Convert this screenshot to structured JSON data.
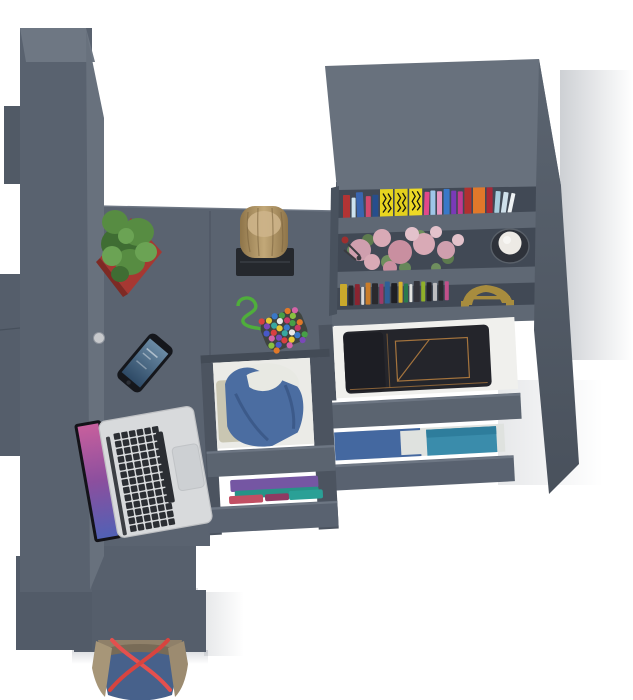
{
  "meta": {
    "scene_label": "graphite gray furniture set - top view render",
    "background": "#ffffff"
  },
  "colors": {
    "desk": "#5a6370",
    "desk_step": "#57606d",
    "desk_column": "#555e6b",
    "seam": "#4d5562",
    "edge_light": "#6d7683",
    "wardrobe_main": "#59626f",
    "wardrobe_top": "#6e7783",
    "wardrobe_edge": "#68717d",
    "wardrobe_side1": "#515a66",
    "wardrobe_side2": "#555e6b",
    "wardrobe_foot": "#525b68",
    "shelf_top_face": "#68717d",
    "shelf_cavity": "#414955",
    "shelf_board": "#5f6874",
    "shelf_left_edge": "#49525e",
    "side_panel_top": "#5b6470",
    "side_panel_bottom": "#49515c",
    "drawer_front": "#5b6470",
    "drawer_front2": "#596270",
    "drawer_rail": "#4c5460",
    "drawer_rail_dark": "#434b56",
    "drawer_interior": "#f0f0ed",
    "drawer_interior2": "#ebebe7",
    "knob": "#c7c9cc"
  },
  "items": {
    "pot": "#a63832",
    "pot_shade": "#7e2a24",
    "cactus_dark": "#3f6d33",
    "cactus_mid": "#578c42",
    "cactus_light": "#6ba354",
    "log_light": "#c2a878",
    "log_dark": "#8f7549",
    "log_top": "#cdb489",
    "log_streak": "#7c6440",
    "mat": "#25282d",
    "phone_body": "#15171c",
    "phone_screen_hi": "#6a8aa4",
    "phone_screen_lo": "#2e4a66",
    "laptop_body": "#d8dadc",
    "laptop_edge": "#bfc1c4",
    "laptop_key": "#2b2e33",
    "trackpad": "#cdd0d3",
    "screen_pink": "#c75f9d",
    "screen_purple": "#8b4f9e",
    "screen_blue": "#5161b5",
    "screen_bezel": "#131318",
    "jeans": "#24252b",
    "jeans_fold": "#1d1e24",
    "stitch": "#a5743d",
    "hoodie": "#4b6da1",
    "hoodie_shade": "#3c5a8a",
    "cloth_white": "#e8e9e3",
    "cloth_khaki": "#c9c6b2",
    "denim_blue": "#4468a0",
    "shirt_teal": "#3a8cab",
    "shirt_teal_dark": "#2e7d9c",
    "cloth_light": "#dfe2df",
    "cord_green": "#4fae3b",
    "bead_backing": "#3f4440",
    "candle": "#edeae5",
    "candle_holder": "#2e323a",
    "eiffel": "#a78c3e",
    "key_metal": "#3b3b40",
    "berry_red": "#9e2f2f",
    "bag_denim": "#47618b",
    "bag_tan": "#a79678",
    "bag_tan_dark": "#9c8b70",
    "bag_interior": "#8f8069",
    "bag_interior_shadow": "#6e6350",
    "strap_red": "#e4504e",
    "strap_red_dark": "#d8443f"
  },
  "books_top": [
    {
      "w": 7,
      "h": 24,
      "c": "#b33434",
      "t": 0
    },
    {
      "w": 4,
      "h": 21,
      "c": "#cde3ef",
      "t": 0
    },
    {
      "w": 7,
      "h": 26,
      "c": "#3a66b0",
      "t": -3
    },
    {
      "w": 5,
      "h": 22,
      "c": "#d14a6e",
      "t": 0
    },
    {
      "w": 6,
      "h": 23,
      "c": "#274e8c",
      "t": 0
    },
    {
      "w": 13,
      "h": 30,
      "c": "#e8d51f",
      "t": 0,
      "z": true
    },
    {
      "w": 13,
      "h": 30,
      "c": "#e3d01d",
      "t": 0,
      "z": true
    },
    {
      "w": 13,
      "h": 31,
      "c": "#edda25",
      "t": 0,
      "z": true
    },
    {
      "w": 5,
      "h": 24,
      "c": "#e2498a",
      "t": 2
    },
    {
      "w": 5,
      "h": 25,
      "c": "#9fc6e8",
      "t": 0
    },
    {
      "w": 5,
      "h": 24,
      "c": "#e898c2",
      "t": 0
    },
    {
      "w": 6,
      "h": 26,
      "c": "#3a78c8",
      "t": 0
    },
    {
      "w": 5,
      "h": 24,
      "c": "#7a3ab8",
      "t": 0
    },
    {
      "w": 5,
      "h": 23,
      "c": "#c03a92",
      "t": 0
    },
    {
      "w": 7,
      "h": 27,
      "c": "#b03030",
      "t": 0
    },
    {
      "w": 12,
      "h": 30,
      "c": "#e0782a",
      "t": 0
    },
    {
      "w": 6,
      "h": 26,
      "c": "#a82838",
      "t": 0
    },
    {
      "w": 5,
      "h": 22,
      "c": "#a9cede",
      "t": 4
    },
    {
      "w": 5,
      "h": 21,
      "c": "#cfe0ea",
      "t": 8
    },
    {
      "w": 4,
      "h": 20,
      "c": "#eef2f4",
      "t": 12
    }
  ],
  "books_bottom": [
    {
      "w": 7,
      "h": 22,
      "c": "#c9a92c"
    },
    {
      "w": 5,
      "h": 20,
      "c": "#26262a"
    },
    {
      "w": 5,
      "h": 21,
      "c": "#8a2430"
    },
    {
      "w": 3,
      "h": 18,
      "c": "#d9d9d9"
    },
    {
      "w": 5,
      "h": 22,
      "c": "#c97d2a"
    },
    {
      "w": 6,
      "h": 21,
      "c": "#2a2a2e"
    },
    {
      "w": 4,
      "h": 20,
      "c": "#9c3a68"
    },
    {
      "w": 5,
      "h": 22,
      "c": "#2f5f96"
    },
    {
      "w": 6,
      "h": 20,
      "c": "#1f1f24"
    },
    {
      "w": 4,
      "h": 21,
      "c": "#d7b22c"
    },
    {
      "w": 4,
      "h": 19,
      "c": "#2a7a4e"
    },
    {
      "w": 3,
      "h": 18,
      "c": "#e3e3e0"
    },
    {
      "w": 6,
      "h": 21,
      "c": "#33333a"
    },
    {
      "w": 4,
      "h": 20,
      "c": "#8fb02a"
    },
    {
      "w": 5,
      "h": 19,
      "c": "#23232a"
    },
    {
      "w": 4,
      "h": 18,
      "c": "#bcbcbf"
    },
    {
      "w": 5,
      "h": 20,
      "c": "#2b2b30"
    },
    {
      "w": 4,
      "h": 19,
      "c": "#c2508a"
    }
  ],
  "beads": {
    "count": 36,
    "colors": [
      "#d94040",
      "#e8c832",
      "#3a78c8",
      "#46a046",
      "#e07828",
      "#d463a8",
      "#7a48b8",
      "#38a8a0",
      "#e8e8e8",
      "#c83a68",
      "#88c040",
      "#4858c8"
    ]
  },
  "flowers": [
    {
      "x": 388,
      "y": 262,
      "r": 7,
      "c": "#6f8f5e"
    },
    {
      "x": 420,
      "y": 236,
      "r": 6,
      "c": "#6f8f5e"
    },
    {
      "x": 448,
      "y": 258,
      "r": 6,
      "c": "#5d7b4e"
    },
    {
      "x": 368,
      "y": 240,
      "r": 6,
      "c": "#5d7b4e"
    },
    {
      "x": 405,
      "y": 268,
      "r": 6,
      "c": "#66875a"
    },
    {
      "x": 436,
      "y": 268,
      "r": 5,
      "c": "#6f8f5e"
    },
    {
      "x": 352,
      "y": 250,
      "r": 5,
      "c": "#66875a"
    },
    {
      "x": 360,
      "y": 250,
      "r": 11,
      "c": "#cf9fae"
    },
    {
      "x": 382,
      "y": 238,
      "r": 9,
      "c": "#d9aab6"
    },
    {
      "x": 400,
      "y": 252,
      "r": 12,
      "c": "#c98fa0"
    },
    {
      "x": 424,
      "y": 244,
      "r": 11,
      "c": "#d9aab6"
    },
    {
      "x": 446,
      "y": 250,
      "r": 9,
      "c": "#cf9fae"
    },
    {
      "x": 372,
      "y": 262,
      "r": 8,
      "c": "#d9aab6"
    },
    {
      "x": 412,
      "y": 234,
      "r": 7,
      "c": "#e3c2cb"
    },
    {
      "x": 436,
      "y": 232,
      "r": 6,
      "c": "#e3c2cb"
    },
    {
      "x": 390,
      "y": 268,
      "r": 7,
      "c": "#c98fa0"
    },
    {
      "x": 458,
      "y": 240,
      "r": 6,
      "c": "#e3c2cb"
    }
  ],
  "clothes_stripes": [
    {
      "x": 228,
      "y": 478,
      "w": 88,
      "h": 12,
      "c": "#7556a3"
    },
    {
      "x": 232,
      "y": 489,
      "w": 84,
      "h": 8,
      "c": "#279387"
    },
    {
      "x": 226,
      "y": 494,
      "w": 34,
      "h": 8,
      "c": "#c24f63"
    },
    {
      "x": 262,
      "y": 494,
      "w": 24,
      "h": 7,
      "c": "#8e3a62"
    },
    {
      "x": 286,
      "y": 492,
      "w": 34,
      "h": 9,
      "c": "#2aa096"
    }
  ],
  "keyboard": {
    "rows": 13,
    "cols": 6,
    "key": 6.4,
    "gapx": 7.8,
    "gapy": 7.8,
    "x0": 121,
    "y0": 428,
    "color": "#2b2e33"
  }
}
